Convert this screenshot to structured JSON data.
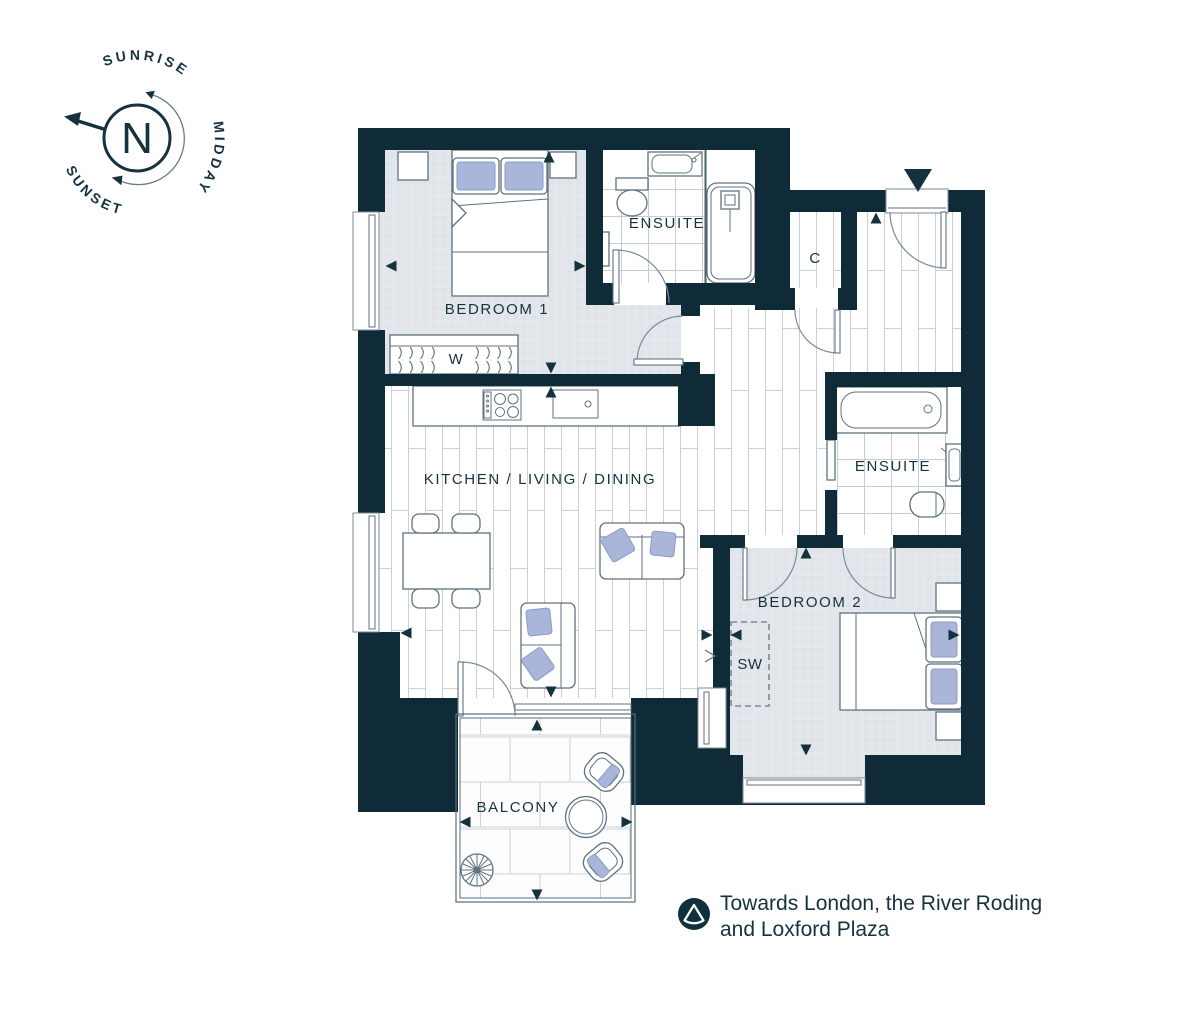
{
  "compass": {
    "north": "N",
    "sunrise": "SUNRISE",
    "midday": "MIDDAY",
    "sunset": "SUNSET"
  },
  "rooms": {
    "bedroom1": "BEDROOM 1",
    "ensuite1": "ENSUITE",
    "cupboard": "C",
    "wardrobe": "W",
    "kitchen_living_dining": "KITCHEN / LIVING / DINING",
    "ensuite2": "ENSUITE",
    "bedroom2": "BEDROOM 2",
    "sliding_wardrobe": "SW",
    "balcony": "BALCONY"
  },
  "caption": {
    "line1": "Towards London, the River Roding",
    "line2": "and Loxford Plaza"
  },
  "icons": {
    "north_arrow": "north-arrow",
    "sun_path": "sun-path-arc",
    "entrance_marker": "entrance-triangle",
    "view_marker": "view-direction-icon"
  },
  "colors": {
    "wall": "#0f2b38",
    "carpet": "#e3e7eb",
    "cushion": "#a9b5d9",
    "floor_line": "#c9d1d7",
    "furniture_line": "#5f7280",
    "text": "#16323f"
  }
}
